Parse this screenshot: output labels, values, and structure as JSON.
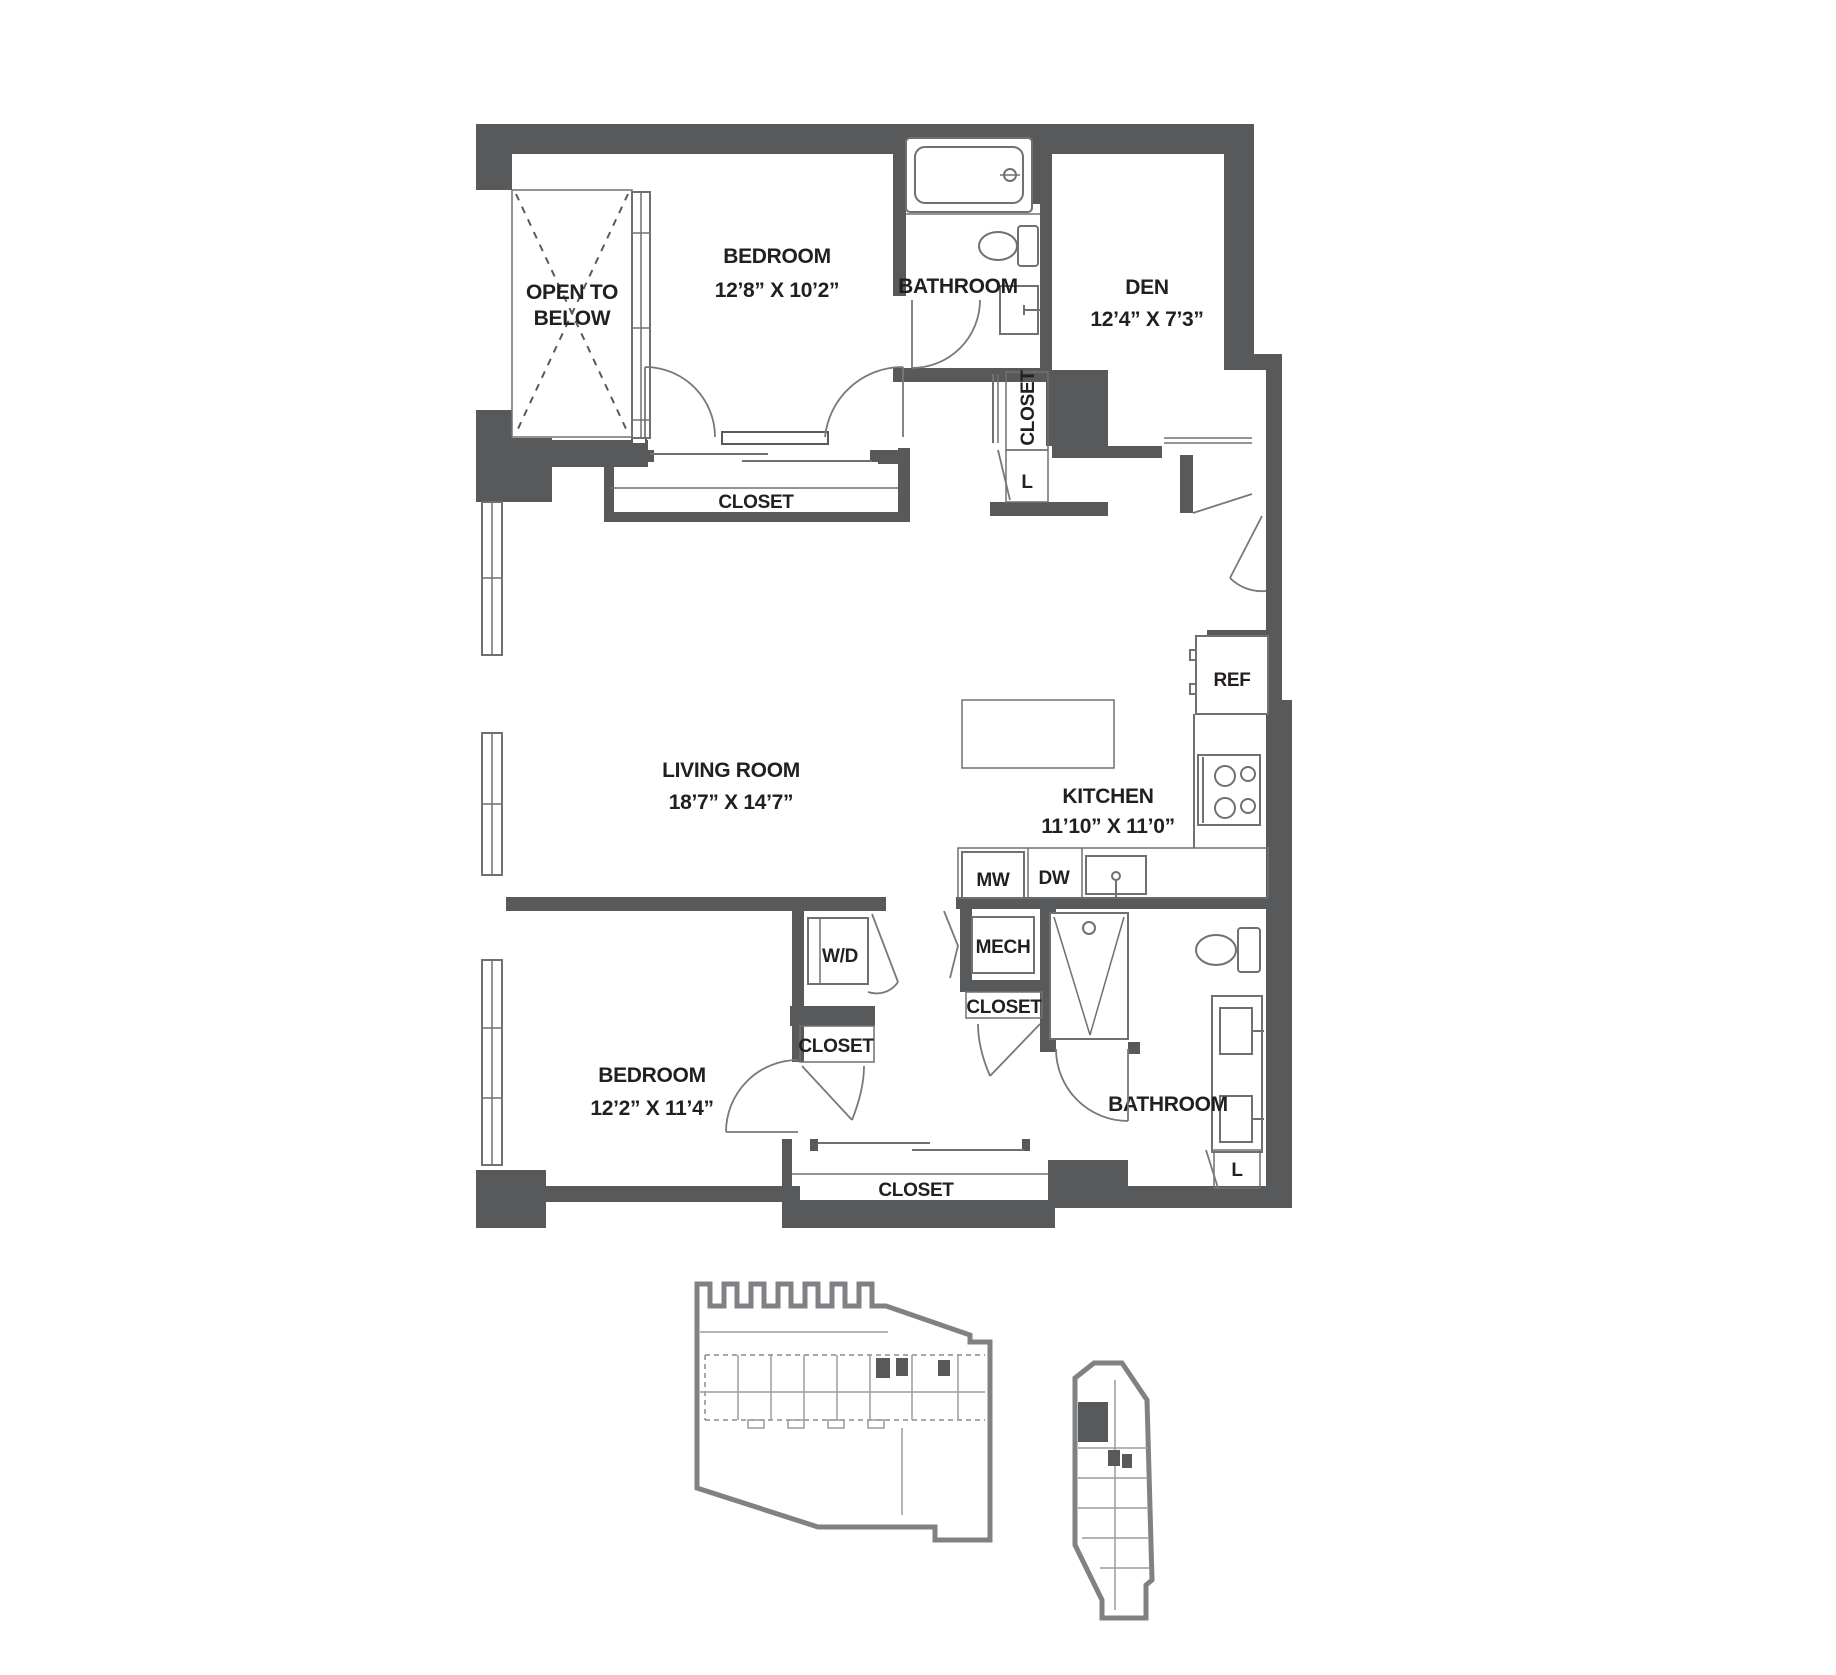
{
  "plan": {
    "open_below_line1": "OPEN TO",
    "open_below_line2": "BELOW",
    "bedroom1_name": "BEDROOM",
    "bedroom1_dims": "12’8” X 10’2”",
    "bathroom1_name": "BATHROOM",
    "den_name": "DEN",
    "den_dims": "12’4” X 7’3”",
    "closet_bed1": "CLOSET",
    "closet_hall": "CLOSET",
    "linen_hall": "L",
    "living_name": "LIVING ROOM",
    "living_dims": "18’7” X 14’7”",
    "kitchen_name": "KITCHEN",
    "kitchen_dims": "11’10” X 11’0”",
    "ref_label": "REF",
    "mw_label": "MW",
    "dw_label": "DW",
    "mech_label": "MECH",
    "wd_label": "W/D",
    "closet_wd": "CLOSET",
    "closet_mech": "CLOSET",
    "bedroom2_name": "BEDROOM",
    "bedroom2_dims": "12’2” X 11’4”",
    "closet_bed2": "CLOSET",
    "bathroom2_name": "BATHROOM",
    "linen_bath2": "L"
  },
  "colors": {
    "wall": "#58595b",
    "text": "#231f20",
    "fixture_line": "#6f7072",
    "keyplan_outline": "#808184"
  }
}
